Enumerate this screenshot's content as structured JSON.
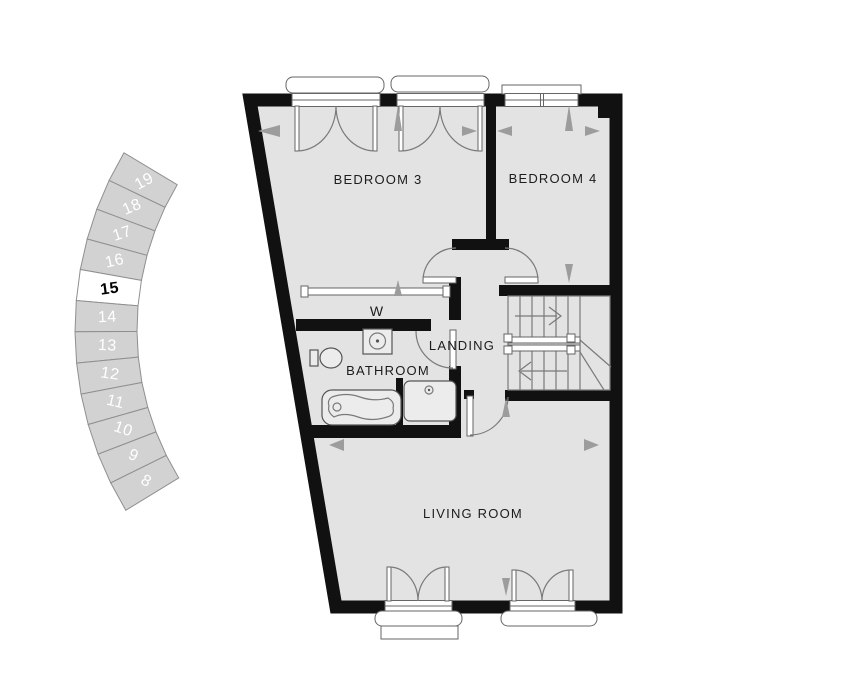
{
  "plot_selector": {
    "plots": [
      "19",
      "18",
      "17",
      "16",
      "15",
      "14",
      "13",
      "12",
      "11",
      "10",
      "9",
      "8"
    ],
    "selected_plot": "15",
    "colors": {
      "segment_fill": "#d2d2d2",
      "segment_border": "#8f8f8f",
      "label": "#ffffff",
      "selected_fill": "#ffffff",
      "selected_label": "#000000"
    }
  },
  "floor_plan": {
    "rooms": {
      "bedroom3": "BEDROOM 3",
      "bedroom4": "BEDROOM 4",
      "landing": "LANDING",
      "bathroom": "BATHROOM",
      "wardrobe": "W",
      "living_room": "LIVING ROOM"
    },
    "colors": {
      "wall": "#111111",
      "floor": "#e3e3e3",
      "line": "#7a7a7a",
      "arrow": "#9c9c9c",
      "label": "#1c1c1c"
    }
  }
}
